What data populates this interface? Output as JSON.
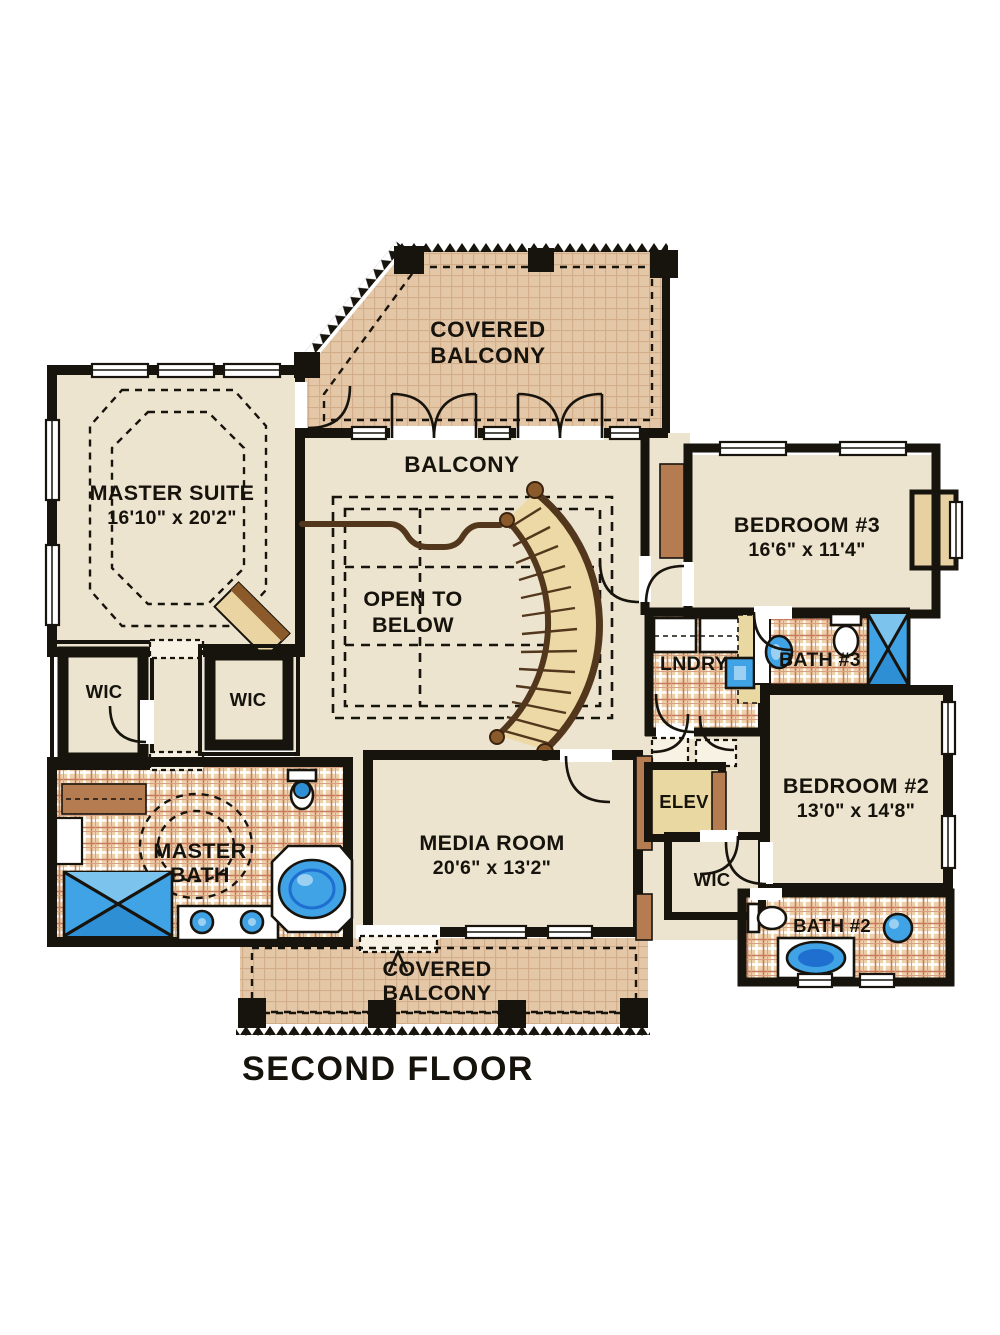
{
  "title": "SECOND FLOOR",
  "plan": {
    "covered_balcony_top": {
      "line1": "COVERED",
      "line2": "BALCONY"
    },
    "balcony": {
      "label": "BALCONY"
    },
    "master_suite": {
      "name": "MASTER SUITE",
      "dims": "16'10\" x 20'2\""
    },
    "open_to_below": {
      "line1": "OPEN TO",
      "line2": "BELOW"
    },
    "bedroom3": {
      "name": "BEDROOM #3",
      "dims": "16'6\" x 11'4\""
    },
    "laundry": {
      "label": "LNDRY"
    },
    "bath3": {
      "label": "BATH #3"
    },
    "wic_left_a": {
      "label": "WIC"
    },
    "wic_left_b": {
      "label": "WIC"
    },
    "master_bath": {
      "line1": "MASTER",
      "line2": "BATH"
    },
    "media_room": {
      "name": "MEDIA ROOM",
      "dims": "20'6\" x 13'2\""
    },
    "elevator": {
      "label": "ELEV"
    },
    "bedroom2": {
      "name": "BEDROOM #2",
      "dims": "13'0\" x 14'8\""
    },
    "wic_right": {
      "label": "WIC"
    },
    "bath2": {
      "label": "BATH #2"
    },
    "covered_balcony_bottom": {
      "line1": "COVERED",
      "line2": "BALCONY"
    }
  },
  "palette": {
    "wall": "#17130d",
    "room_floor": "#ece4cf",
    "balcony_tile": "#e4c7a7",
    "bath_tile": "#eed0a8",
    "wood_brown": "#b57b51",
    "stair_tan": "#ecd9a6",
    "fixture_blue": "#3fa3e6",
    "fixture_blue_dark": "#1e6fd0"
  }
}
